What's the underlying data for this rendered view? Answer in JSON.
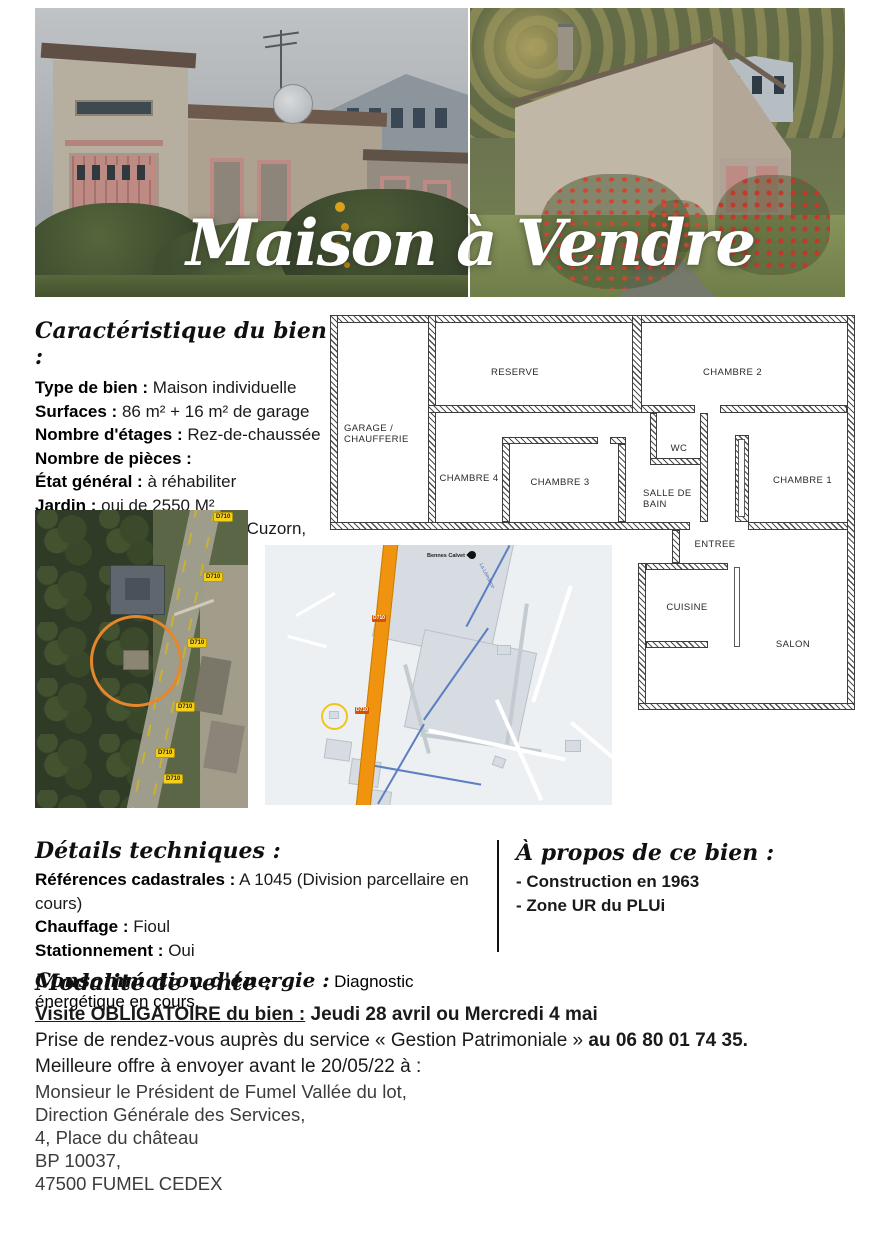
{
  "header": {
    "title": "Maison à Vendre"
  },
  "caracteristiques": {
    "heading": "Caractéristique du bien :",
    "items": [
      {
        "label": "Type de bien :",
        "value": "Maison individuelle"
      },
      {
        "label": "Surfaces :",
        "value": "86 m² + 16 m² de garage"
      },
      {
        "label": "Nombre d'étages :",
        "value": "Rez-de-chaussée"
      },
      {
        "label": "Nombre de pièces :",
        "value": ""
      },
      {
        "label": "État général :",
        "value": "à réhabiliter"
      },
      {
        "label": "Jardin :",
        "value": "oui de 2550 M²"
      },
      {
        "label": "Commune / Localisation :",
        "value": "Cuzorn, sur D710"
      }
    ]
  },
  "floorplan": {
    "rooms": {
      "garage": "GARAGE / CHAUFFERIE",
      "reserve": "RESERVE",
      "chambre2": "CHAMBRE 2",
      "chambre4": "CHAMBRE 4",
      "chambre3": "CHAMBRE 3",
      "wc": "WC",
      "salle_de_bain": "SALLE DE BAIN",
      "chambre1": "CHAMBRE 1",
      "entree": "ENTREE",
      "cuisine": "CUISINE",
      "salon": "SALON"
    }
  },
  "satellite": {
    "road_label": "D710"
  },
  "map": {
    "poi_label": "Bennes Calvet",
    "river_label": "La Lémance",
    "road_label": "D710"
  },
  "details": {
    "heading": "Détails techniques :",
    "items": [
      {
        "label": "Références cadastrales :",
        "value": "A 1045 (Division parcellaire en cours)"
      },
      {
        "label": "Chauffage :",
        "value": "Fioul"
      },
      {
        "label": "Stationnement :",
        "value": "Oui"
      }
    ],
    "energy_label": "Consommation d'énergie :",
    "energy_value": "Diagnostic énergétique en cours."
  },
  "apropos": {
    "heading": "À propos de ce bien :",
    "items": [
      "- Construction en 1963",
      "- Zone UR du PLUi"
    ]
  },
  "modalite": {
    "heading": "Modalité de vente :",
    "visit_label": "Visite OBLIGATOIRE du bien :",
    "visit_value": " Jeudi 28 avril ou Mercredi 4 mai",
    "rdv_text": "Prise de rendez-vous auprès du service « Gestion Patrimoniale » ",
    "rdv_phone": "au 06 80 01 74 35.",
    "offer_line": "Meilleure offre à envoyer avant le 20/05/22 à :",
    "address_lines": [
      "Monsieur le Président de Fumel Vallée du lot,",
      "Direction Générale des Services,",
      "4, Place du château",
      "BP 10037,",
      "47500 FUMEL CEDEX"
    ]
  },
  "colors": {
    "highlight_circle_orange": "#e8862c",
    "map_road_orange": "#f0940f",
    "road_chip_yellow": "#f4cf1c",
    "river_blue": "#5b7fc0",
    "title_white": "#ffffff"
  }
}
